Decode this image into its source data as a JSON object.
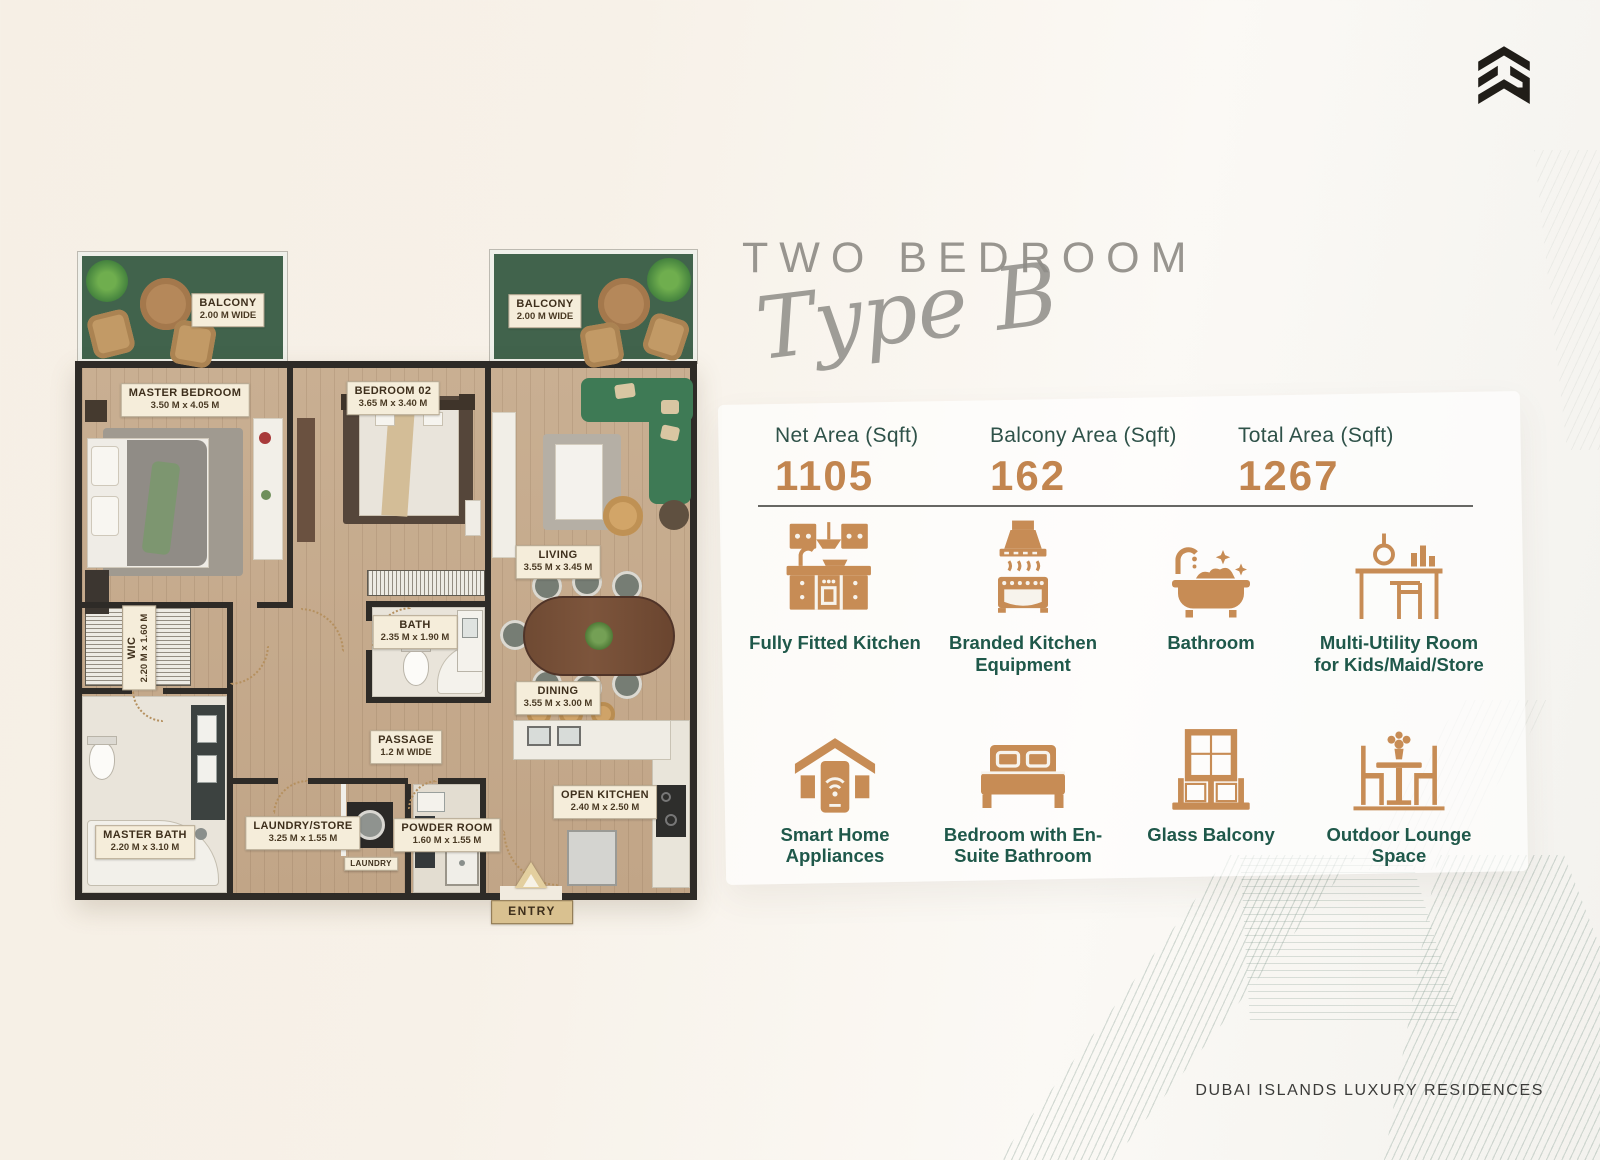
{
  "header": {
    "title": "TWO BEDROOM",
    "subtitle": "Type B"
  },
  "stats": {
    "items": [
      {
        "label": "Net Area (Sqft)",
        "value": "1105"
      },
      {
        "label": "Balcony Area (Sqft)",
        "value": "162"
      },
      {
        "label": "Total Area (Sqft)",
        "value": "1267"
      }
    ]
  },
  "features": [
    {
      "icon": "kitchen-cabinets-icon",
      "label": "Fully Fitted Kitchen"
    },
    {
      "icon": "oven-hood-icon",
      "label": "Branded Kitchen Equipment"
    },
    {
      "icon": "bathtub-icon",
      "label": "Bathroom"
    },
    {
      "icon": "utility-desk-icon",
      "label": "Multi-Utility Room for Kids/Maid/Store"
    },
    {
      "icon": "smart-home-icon",
      "label": "Smart Home Appliances"
    },
    {
      "icon": "bed-icon",
      "label": "Bedroom with En-Suite Bathroom"
    },
    {
      "icon": "glass-balcony-icon",
      "label": "Glass Balcony"
    },
    {
      "icon": "outdoor-lounge-icon",
      "label": "Outdoor Lounge Space"
    }
  ],
  "plan": {
    "rooms": [
      {
        "id": "balcony-left",
        "name": "BALCONY",
        "dims": "2.00 M WIDE"
      },
      {
        "id": "balcony-right",
        "name": "BALCONY",
        "dims": "2.00 M WIDE"
      },
      {
        "id": "master-bedroom",
        "name": "MASTER BEDROOM",
        "dims": "3.50 M x 4.05 M"
      },
      {
        "id": "bedroom-02",
        "name": "BEDROOM 02",
        "dims": "3.65 M x 3.40 M"
      },
      {
        "id": "living",
        "name": "LIVING",
        "dims": "3.55 M x 3.45 M"
      },
      {
        "id": "wic",
        "name": "WIC",
        "dims": "2.20 M x 1.60 M"
      },
      {
        "id": "bath",
        "name": "BATH",
        "dims": "2.35 M x 1.90 M"
      },
      {
        "id": "dining",
        "name": "DINING",
        "dims": "3.55 M x 3.00 M"
      },
      {
        "id": "passage",
        "name": "PASSAGE",
        "dims": "1.2 M WIDE"
      },
      {
        "id": "master-bath",
        "name": "MASTER BATH",
        "dims": "2.20 M x 3.10 M"
      },
      {
        "id": "laundry-store",
        "name": "LAUNDRY/STORE",
        "dims": "3.25 M x 1.55 M"
      },
      {
        "id": "laundry",
        "name": "LAUNDRY"
      },
      {
        "id": "powder-room",
        "name": "POWDER ROOM",
        "dims": "1.60 M x 1.55 M"
      },
      {
        "id": "open-kitchen",
        "name": "OPEN KITCHEN",
        "dims": "2.40 M x 2.50 M"
      },
      {
        "id": "entry",
        "name": "ENTRY"
      }
    ]
  },
  "footer": {
    "text": "DUBAI ISLANDS LUXURY RESIDENCES"
  },
  "brand": {
    "logo_icon": "brand-chevron-logo"
  },
  "colors": {
    "accent_orange": "#C78C55",
    "number_orange": "#C2854F",
    "teal_text": "#1F584A",
    "stat_label_teal": "#2F5249",
    "heading_gray": "#98958F",
    "balcony_green": "#41634C",
    "sofa_green": "#3E7A55",
    "wall_dark": "#2E2B27",
    "wood_floor": "#C7AD90",
    "page_cream": "#F6F0E7",
    "chip_cream": "#F5EDDA"
  }
}
